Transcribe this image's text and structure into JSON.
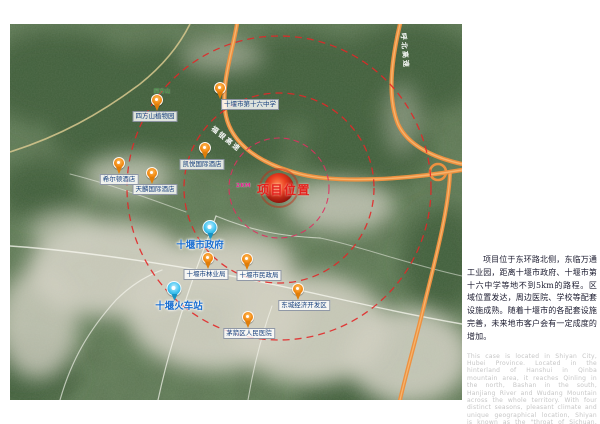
{
  "map": {
    "project": {
      "label": "项目位置",
      "radius_label": "2KM"
    },
    "expressways": [
      {
        "name": "福银高速"
      },
      {
        "name": "呼北高速"
      }
    ],
    "terrain_place": "四方山",
    "pins": [
      {
        "label": "四方山植物园",
        "type": "orange"
      },
      {
        "label": "十堰市第十六中学",
        "type": "orange"
      },
      {
        "label": "凯悦国际酒店",
        "type": "orange"
      },
      {
        "label": "希尔顿酒店",
        "type": "orange"
      },
      {
        "label": "天麟国际酒店",
        "type": "orange"
      },
      {
        "label": "十堰市政府",
        "type": "blue"
      },
      {
        "label": "十堰市林业局",
        "type": "orange"
      },
      {
        "label": "十堰市民政局",
        "type": "orange"
      },
      {
        "label": "十堰火车站",
        "type": "blue"
      },
      {
        "label": "东城经济开发区",
        "type": "orange"
      },
      {
        "label": "茅箭区人民医院",
        "type": "orange"
      }
    ],
    "colors": {
      "expressway": "#ed9140",
      "radius_circle": "#e22828",
      "radius_circle_inner": "#e03060",
      "pin_orange": "#f28a12",
      "pin_blue": "#41c3f0",
      "poi_label_text": "#17407e",
      "major_label_text": "#1b6fd0",
      "project_text": "#e5201c"
    }
  },
  "description": {
    "zh": "项目位于东环路北侧，东临万通工业园，距离十堰市政府、十堰市第十六中学等地不到5km的路程。区域位置发达，周边医院、学校等配套设施成熟。随着十堰市的各配套设施完善，未来地市客户会有一定成度的增加。",
    "en": "This case is located in Shiyan City, Hubei Province. Located in the hinterland of Hanshui in Qinba mountain area, it reaches Qinling in the north, Bashan in the south, Hanjiang River and Wudang Mountain across the whole territory. With four distinct seasons, pleasant climate and unique geographical location, Shiyan is known as the \"throat of Sichuan, Shaanxi and thoroughfare of four provinces\"."
  }
}
